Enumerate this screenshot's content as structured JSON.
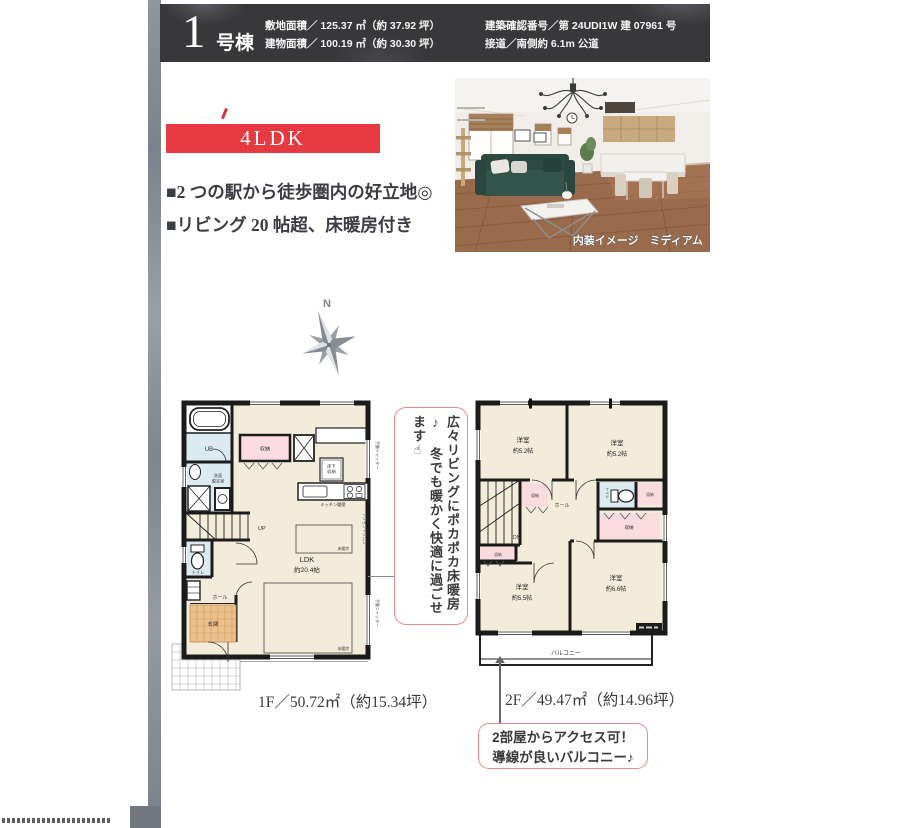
{
  "header": {
    "unit_number": "1",
    "unit_suffix": "号棟",
    "land_area": "敷地面積／ 125.37 ㎡（約 37.92 坪）",
    "building_area": "建物面積／ 100.19 ㎡（約 30.30 坪）",
    "confirmation_number": "建築確認番号／第 24UDI1W 建 07961 号",
    "road_access": "接道／南側約 6.1m 公道"
  },
  "badge": {
    "layout": "4LDK"
  },
  "features": [
    "■2 つの駅から徒歩圏内の好立地◎",
    "■リビング 20 帖超、床暖房付き"
  ],
  "photo": {
    "caption": "内装イメージ　ミディアム"
  },
  "compass": {
    "north": "N"
  },
  "floor1": {
    "labels": {
      "ub": "UB",
      "washroom1": "洗面",
      "washroom2": "脱衣室",
      "closet": "収納",
      "underfloor1": "床下",
      "underfloor2": "収納",
      "kitchen_wall": "キッチン腰壁",
      "up": "UP",
      "ldk": "LDK",
      "ldk_size": "約20.4帖",
      "floor_heating": "床暖房",
      "toilet": "トイレ",
      "hall": "ホール",
      "entrance": "玄関",
      "shutter": "手動シャッター",
      "accent_cloth": "アクセントクロス"
    },
    "area_label": "1F／50.72㎡（約15.34坪）"
  },
  "floor2": {
    "labels": {
      "bedroom": "洋室",
      "size_a": "約5.2帖",
      "size_b": "約5.2帖",
      "size_c": "約5.5帖",
      "size_d": "約6.6帖",
      "dn": "DN",
      "closet": "収納",
      "hall": "ホール",
      "toilet": "トイレ",
      "balcony": "バルコニー"
    },
    "area_label": "2F／49.47㎡（約14.96坪）"
  },
  "callouts": {
    "heating_line1": "広々リビングにポカポカ床暖房♪",
    "heating_line2": "冬でも暖かく快適に過ごせます☝",
    "balcony_line1": "2部屋からアクセス可！",
    "balcony_line2": "導線が良いバルコニー♪"
  },
  "colors": {
    "accent_red": "#e63a40",
    "header_bg": "#38383b",
    "room_beige": "#f3ecda",
    "wet_blue": "#dcebf2",
    "closet_pink": "#fadbde",
    "entrance_tile": "#eec08e",
    "callout_border": "#e8898c"
  }
}
